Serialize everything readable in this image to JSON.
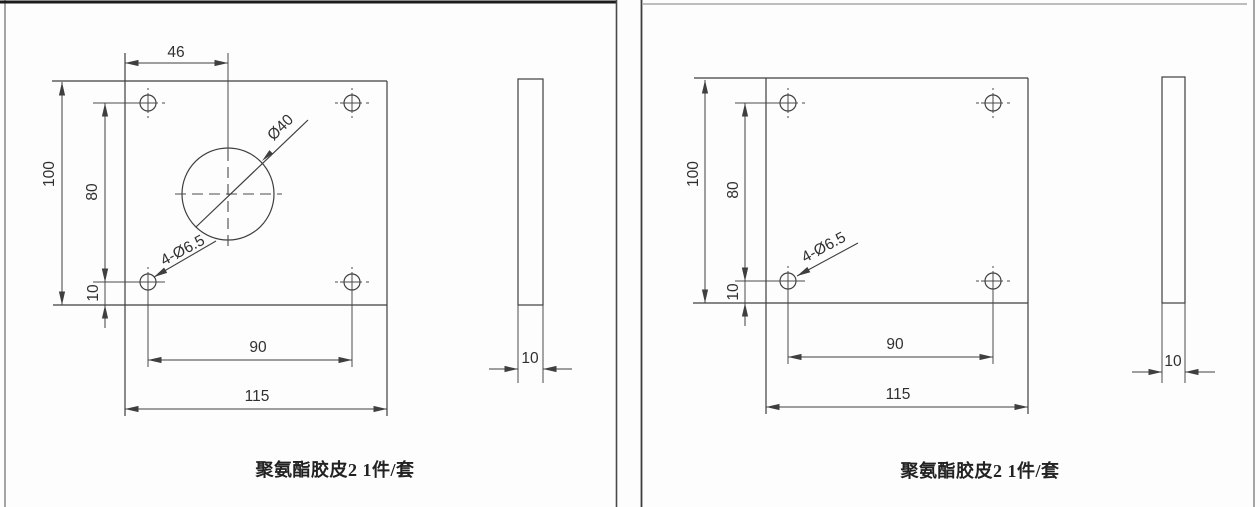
{
  "pages": {
    "left": {
      "caption": "聚氨酯胶皮2 1件/套",
      "dims": {
        "hole_center_offset": "46",
        "plate_height": "100",
        "hole_row_spacing": "80",
        "hole_edge_margin": "10",
        "hole_col_spacing": "90",
        "plate_width": "115",
        "center_hole": "Ø40",
        "corner_holes": "4-Ø6.5",
        "thickness": "10"
      }
    },
    "right": {
      "caption": "聚氨酯胶皮2 1件/套",
      "dims": {
        "plate_height": "100",
        "hole_row_spacing": "80",
        "hole_edge_margin": "10",
        "hole_col_spacing": "90",
        "plate_width": "115",
        "corner_holes": "4-Ø6.5",
        "thickness": "10"
      }
    }
  }
}
